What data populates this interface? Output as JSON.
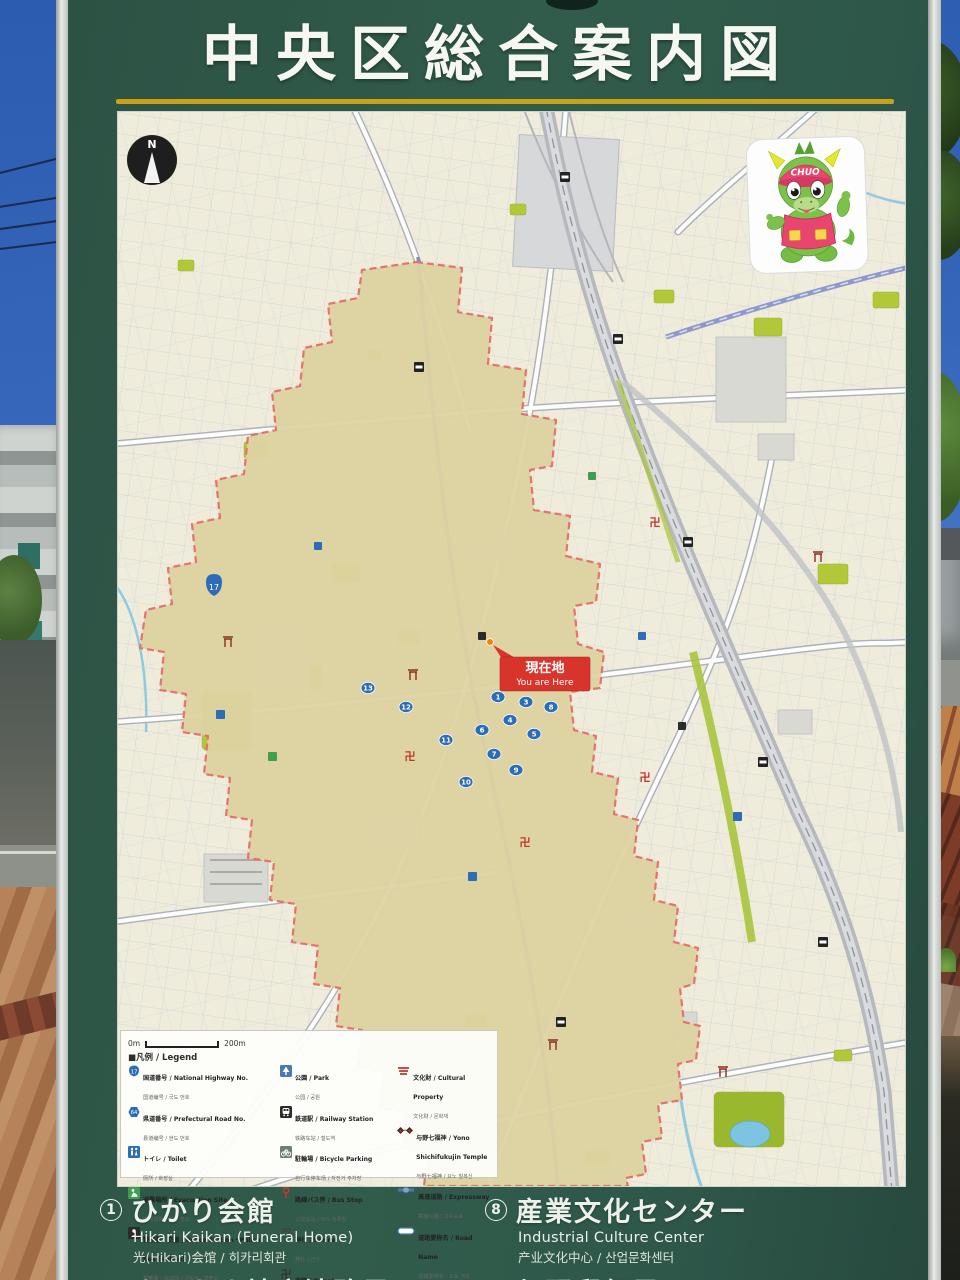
{
  "sign": {
    "title": "中央区総合案内図"
  },
  "map": {
    "north_label": "N",
    "scale_start": "0m",
    "scale_end": "200m",
    "you_are_here_jp": "現在地",
    "you_are_here_en": "You are Here",
    "mascot_cap_text": "CHUO",
    "route_badge": "17",
    "temple_glyph": "卍",
    "markers": [
      "1",
      "2",
      "3",
      "4",
      "5",
      "6",
      "7",
      "8",
      "9",
      "10",
      "11",
      "12",
      "13"
    ]
  },
  "legend": {
    "heading": "■凡例 / Legend",
    "note": "※文化財は公開していないものもあります。また、個人所有の文化財については掲載していないものもあります。",
    "badge_17": "17",
    "badge_64": "64",
    "items": [
      {
        "label": "国道番号 / National Highway No.",
        "sub": "国道编号 / 국도 번호"
      },
      {
        "label": "県道番号 / Prefectural Road No.",
        "sub": "县道编号 / 현도 번호"
      },
      {
        "label": "トイレ / Toilet",
        "sub": "厕所 / 화장실"
      },
      {
        "label": "避難場所 / Evacuation Site",
        "sub": "避难场所 / 피난 장소"
      },
      {
        "label": "警察署・交番 / Police Station・Police Box (Koban)",
        "sub": "警察署・派出所 / 경찰서・파출소"
      },
      {
        "label": "郵便局 / Post Office",
        "sub": "邮局 / 우체국"
      },
      {
        "label": "公園 / Park",
        "sub": "公园 / 공원"
      },
      {
        "label": "鉄道駅 / Railway Station",
        "sub": "铁路车站 / 철도역"
      },
      {
        "label": "駐輪場 / Bicycle Parking",
        "sub": "自行车停车场 / 자전거 주차장"
      },
      {
        "label": "路線バス停 / Bus Stop",
        "sub": "公交车站 / 버스 정류장"
      },
      {
        "label": "神社 / Shrine",
        "sub": "神社 / 신사"
      },
      {
        "label": "寺院 / Temple",
        "sub": "寺院 / 사원"
      },
      {
        "label": "文化財 / Cultural Property",
        "sub": "文化财 / 문화재"
      },
      {
        "label": "与野七福神 / Yono Shichifukujin Temple",
        "sub": "与野七福神 / 요노 칠복신"
      },
      {
        "label": "高速道路 / Expressway",
        "sub": "高速公路 / 고속도로"
      },
      {
        "label": "道路愛称名 / Road Name",
        "sub": "道路爱称名 / 도로 애칭"
      }
    ]
  },
  "directory": {
    "items": [
      {
        "num": "1",
        "jp": "ひかり会館",
        "en": "Hikari Kaikan (Funeral Home)",
        "sub": "光(Hikari)会馆 / 히카리회관"
      },
      {
        "num": "2",
        "jp": "さいたま地方法務局",
        "en": "Saitama Regional Legal Affairs Bureau",
        "sub": ""
      },
      {
        "num": "8",
        "jp": "産業文化センター",
        "en": "Industrial Culture Center",
        "sub": "产业文化中心 / 산업문화센터"
      },
      {
        "num": "9",
        "jp": "与野郵便局",
        "en": "Yono Post Office",
        "sub": ""
      }
    ]
  },
  "palette": {
    "board_green": "#2F5848",
    "accent_yellow": "#C9A21A",
    "sky_blue": "#3A6FC0",
    "map_base": "#EFECDC",
    "ward_tan": "#DDD3A2",
    "boundary_red": "#E4736B",
    "park_green": "#B2C839",
    "rail_blue": "#7E8CC7",
    "marker_blue": "#2D6DB8",
    "here_red": "#D9342B",
    "mascot_green": "#7CC24A",
    "mascot_pink": "#E8456F"
  }
}
